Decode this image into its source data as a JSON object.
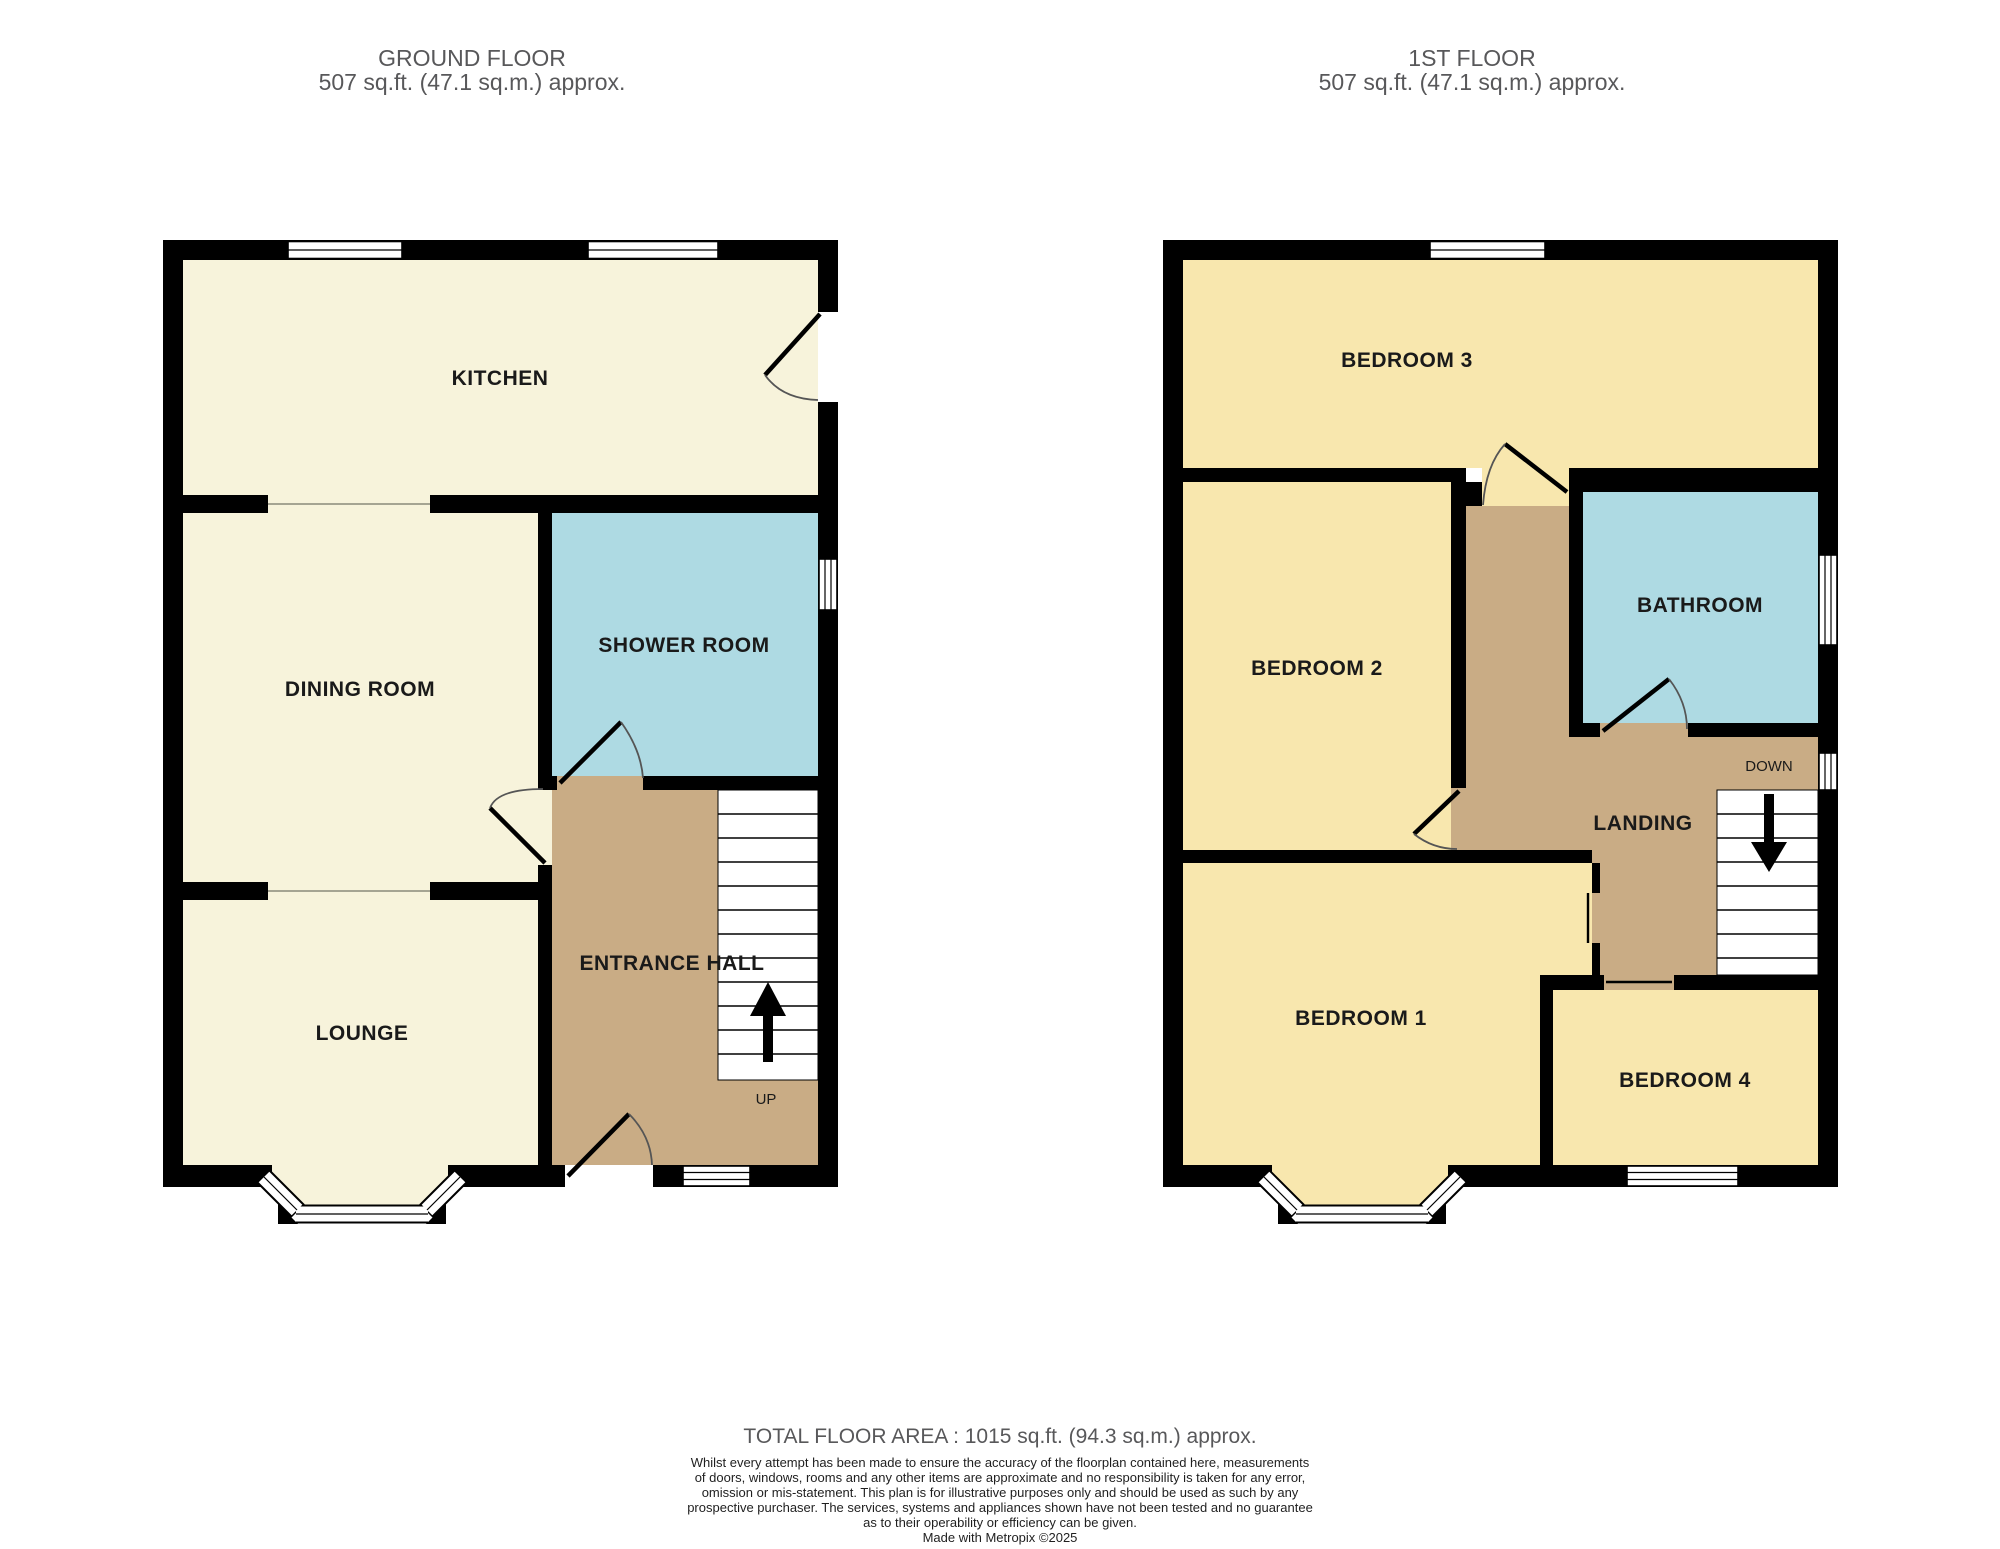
{
  "ground_floor": {
    "title": "GROUND FLOOR",
    "subtitle": "507 sq.ft. (47.1 sq.m.) approx.",
    "rooms": {
      "kitchen": "KITCHEN",
      "dining": "DINING ROOM",
      "shower": "SHOWER ROOM",
      "lounge": "LOUNGE",
      "hall": "ENTRANCE HALL"
    },
    "stairs_label": "UP"
  },
  "first_floor": {
    "title": "1ST FLOOR",
    "subtitle": "507 sq.ft. (47.1 sq.m.) approx.",
    "rooms": {
      "bedroom3": "BEDROOM 3",
      "bedroom2": "BEDROOM 2",
      "bathroom": "BATHROOM",
      "landing": "LANDING",
      "bedroom1": "BEDROOM 1",
      "bedroom4": "BEDROOM 4"
    },
    "stairs_label": "DOWN"
  },
  "footer": {
    "total_area": "TOTAL FLOOR AREA : 1015 sq.ft. (94.3 sq.m.) approx.",
    "disclaimer_lines": [
      "Whilst every attempt has been made to ensure the accuracy of the floorplan contained here, measurements",
      "of doors, windows, rooms and any other items are approximate and no responsibility is taken for any error,",
      "omission or mis-statement. This plan is for illustrative purposes only and should be used as such by any",
      "prospective purchaser. The services, systems and appliances shown have not been tested and no guarantee",
      "as to their operability or efficiency can be given."
    ],
    "credit": "Made with Metropix ©2025"
  },
  "colors": {
    "wall": "#000000",
    "cream": "#F7F3DB",
    "yellow": "#F8E7AE",
    "tan": "#C9AC85",
    "blue": "#AEDAE3",
    "label": "#1A1A1A",
    "title": "#58585A",
    "disclaimer": "#1F1F1F",
    "arc": "#555555",
    "divider": "#8A8A7A"
  }
}
